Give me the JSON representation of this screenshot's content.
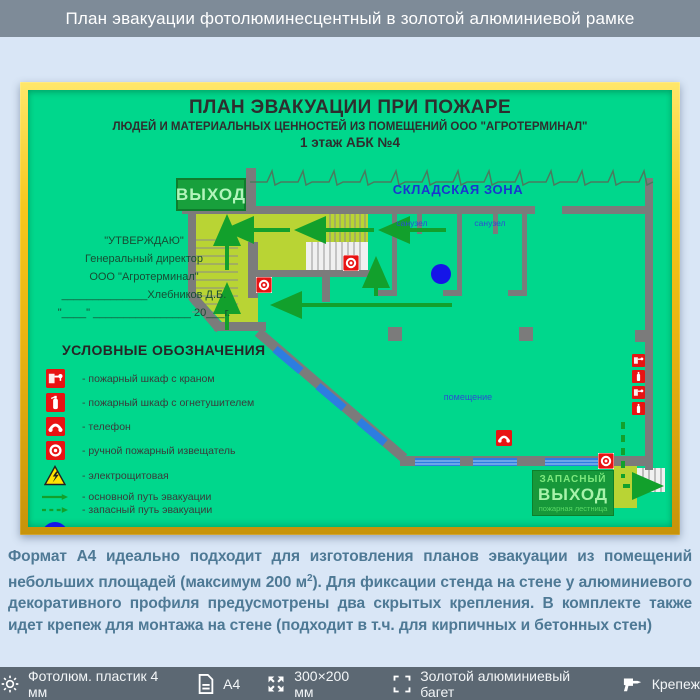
{
  "header": {
    "title": "План эвакуации фотолюминесцентный в золотой алюминиевой рамке"
  },
  "plan": {
    "title1": "ПЛАН ЭВАКУАЦИИ ПРИ ПОЖАРЕ",
    "title2": "ЛЮДЕЙ И МАТЕРИАЛЬНЫХ ЦЕННОСТЕЙ ИЗ ПОМЕЩЕНИЙ ООО \"АГРОТЕРМИНАЛ\"",
    "title3": "1 этаж АБК №4",
    "exit_label": "ВЫХОД",
    "storage_zone_label": "СКЛАДСКАЯ ЗОНА",
    "bathroom1_label": "санузел",
    "bathroom2_label": "санузел",
    "room_label": "помещение",
    "emergency_exit": {
      "line1": "ЗАПАСНЫЙ",
      "line2": "ВЫХОД",
      "line3": "пожарная лестница"
    },
    "approval": {
      "line1": "\"УТВЕРЖДАЮ\"",
      "line2": "Генеральный директор",
      "line3": "ООО \"Агротерминал\"",
      "line4": "______________Хлебников Д.Б.",
      "line5": "\"____\" ________________ 20___г."
    },
    "legend": {
      "title": "УСЛОВНЫЕ ОБОЗНАЧЕНИЯ",
      "items": [
        {
          "icon": "fire-cabinet-crane-icon",
          "label": "- пожарный шкаф с краном"
        },
        {
          "icon": "fire-cabinet-extinguisher-icon",
          "label": "- пожарный шкаф с огнетушителем"
        },
        {
          "icon": "phone-icon",
          "label": "- телефон"
        },
        {
          "icon": "manual-fire-alarm-icon",
          "label": "- ручной пожарный извещатель"
        },
        {
          "icon": "electrical-room-icon",
          "label": "- электрощитовая"
        },
        {
          "icon": "main-route-arrow-icon",
          "label": "- основной путь эвакуации"
        },
        {
          "icon": "backup-route-arrow-icon",
          "label": "- запасный путь эвакуации"
        },
        {
          "icon": "you-are-here-icon",
          "label": "- вы находитесь здесь"
        }
      ]
    }
  },
  "description": {
    "text_before_sup": "Формат А4 идеально подходит для изготовления планов эвакуации из помещений небольших площадей (максимум 200 м",
    "sup": "2",
    "text_after_sup": "). Для фиксации стенда на стене у алюминиевого декоративного профиля предусмотрены два скрытых крепления. В комплекте также идет крепеж для монтажа на стене (подходит в т.ч. для кирпичных и бетонных стен)"
  },
  "footer": {
    "items": [
      {
        "icon": "gear-icon",
        "label": "Фотолюм. пластик 4 мм"
      },
      {
        "icon": "document-icon",
        "label": "А4"
      },
      {
        "icon": "resize-icon",
        "label": "300×200 мм"
      },
      {
        "icon": "frame-corners-icon",
        "label": "Золотой алюминиевый багет"
      },
      {
        "icon": "drill-icon",
        "label": "Крепеж"
      }
    ]
  },
  "colors": {
    "banner_gray": "#7e8b98",
    "frame_gold": "#f6c71c",
    "plan_green": "#00d78c",
    "stairhall_yellow": "#b9d434",
    "wall_gray": "#7b7b7b",
    "route_green": "#12a02c",
    "alarm_red": "#e81313",
    "marker_blue": "#1515e8"
  }
}
